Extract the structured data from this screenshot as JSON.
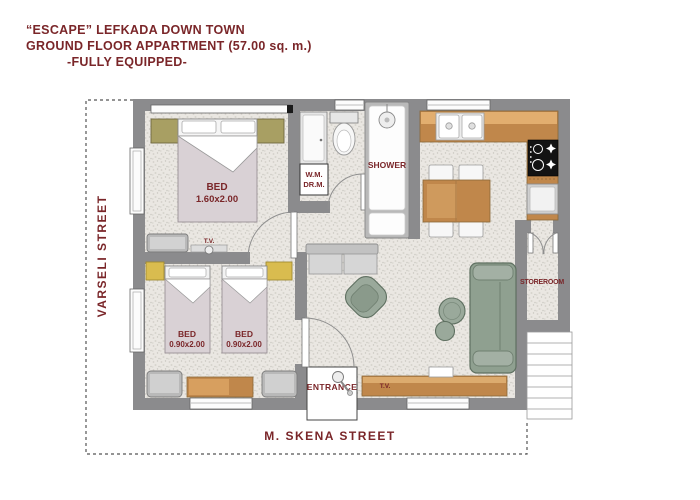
{
  "title": {
    "line1": "“ESCAPE”  LEFKADA DOWN TOWN",
    "line2": "GROUND  FLOOR APPARTMENT (57.00 sq. m.)",
    "line3": "-FULLY EQUIPPED-"
  },
  "streets": {
    "left": "VARSELI STREET",
    "bottom": "M. SKENA STREET"
  },
  "rooms": {
    "master_bedroom": {
      "bed_label": "BED",
      "bed_size": "1.60x2.00",
      "tv_label": "T.V."
    },
    "bedroom2": {
      "bed_a_label": "BED",
      "bed_a_size": "0.90x2.00",
      "bed_b_label": "BED",
      "bed_b_size": "0.90x2.00"
    },
    "bathroom": {
      "shower_label": "SHOWER",
      "wm_line1": "W.M.",
      "wm_line2": "DR.M."
    },
    "living": {
      "tv_label": "T.V."
    },
    "storeroom": {
      "label": "STOREROOM"
    },
    "entrance": {
      "label": "ENTRANCE"
    }
  },
  "colors": {
    "text_maroon": "#7a2629",
    "wall_gray": "#8b8b8d",
    "floor_base": "#eae7e2",
    "counter_wood": "#c0874b",
    "sofa_sage": "#9aa99b",
    "nightstand_olive": "#a89f63",
    "nightstand_yellow": "#d9bc4f",
    "mattress_mauve": "#d9d1d5"
  }
}
